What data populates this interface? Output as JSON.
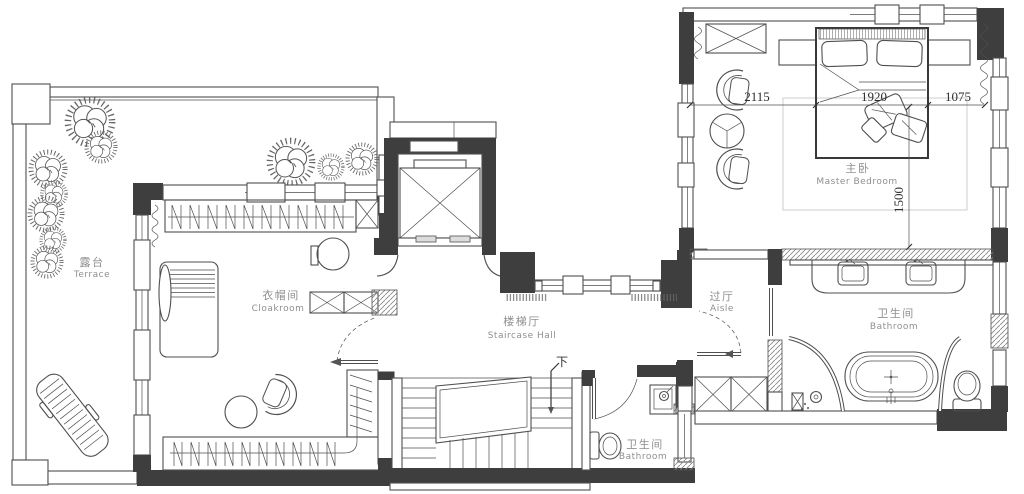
{
  "floor_plan": {
    "rooms": {
      "terrace": {
        "zh": "露台",
        "en": "Terrace"
      },
      "cloakroom": {
        "zh": "衣帽间",
        "en": "Cloakroom"
      },
      "staircase_hall": {
        "zh": "楼梯厅",
        "en": "Staircase Hall"
      },
      "aisle": {
        "zh": "过厅",
        "en": "Aisle"
      },
      "master_bedroom": {
        "zh": "主卧",
        "en": "Master Bedroom"
      },
      "master_bathroom": {
        "zh": "卫生间",
        "en": "Bathroom"
      },
      "guest_bathroom": {
        "zh": "卫生间",
        "en": "Bathroom"
      }
    },
    "dimensions": {
      "left_width": "2115",
      "bed_width": "1920",
      "right_width": "1075",
      "bed_depth": "1500"
    },
    "stairs": {
      "direction_label": "下"
    },
    "colors": {
      "wall": "#3e3e3e",
      "line": "#4f4f4f",
      "label": "#8f8f8f",
      "dim": "#2f2f2f"
    }
  }
}
